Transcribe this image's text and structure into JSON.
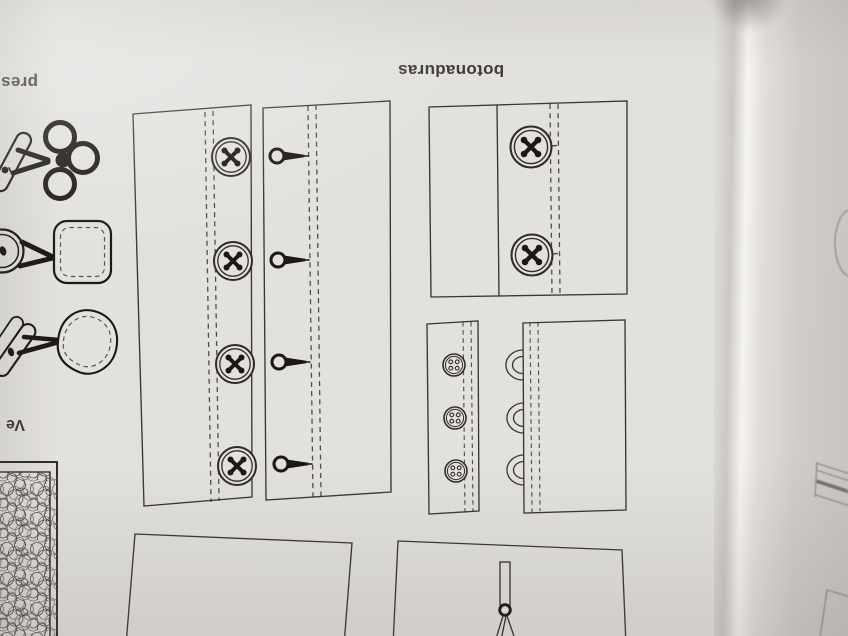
{
  "labels": {
    "word_fragment_top_left": "pres",
    "section_title": "botonaduras",
    "word_fragment_mid_left": "Ve"
  },
  "colors": {
    "paper": "#e3e1de",
    "ink": "#3a3733",
    "black": "#1c1915",
    "text": "#3f3c38",
    "faint": "#8e8b86",
    "adjacent-page": "#cbc8c4"
  },
  "icons": {
    "left_column": [
      {
        "name": "frog-toggle-closure-icon"
      },
      {
        "name": "button-square-patch-icon"
      },
      {
        "name": "toggle-teardrop-patch-icon"
      },
      {
        "name": "velcro-strip-icon"
      }
    ]
  },
  "repeats": {
    "placket-buttons": {
      "href": "#btn4",
      "icon": "four-hole-button-icon",
      "pts": [
        [
          231,
          157
        ],
        [
          233,
          261
        ],
        [
          235,
          364
        ],
        [
          237,
          466
        ]
      ]
    },
    "placket-buttonholes": {
      "href": "#keyhole",
      "icon": "keyhole-buttonhole-icon",
      "pts": [
        [
          277,
          156
        ],
        [
          278,
          260
        ],
        [
          279,
          362
        ],
        [
          281,
          464
        ]
      ]
    },
    "edge-buttons": {
      "href": "#btnEdge",
      "icon": "shank-button-icon",
      "pts": [
        [
          531,
          147
        ],
        [
          532,
          255
        ]
      ]
    },
    "cuff-buttons": {
      "href": "#btnSmall",
      "icon": "small-four-hole-button-icon",
      "pts": [
        [
          454,
          365
        ],
        [
          455,
          418
        ],
        [
          456,
          471
        ]
      ]
    },
    "loops": {
      "href": "#loop",
      "icon": "button-loop-icon",
      "pts": [
        [
          517,
          365
        ],
        [
          518,
          418
        ],
        [
          518,
          470
        ]
      ]
    }
  }
}
